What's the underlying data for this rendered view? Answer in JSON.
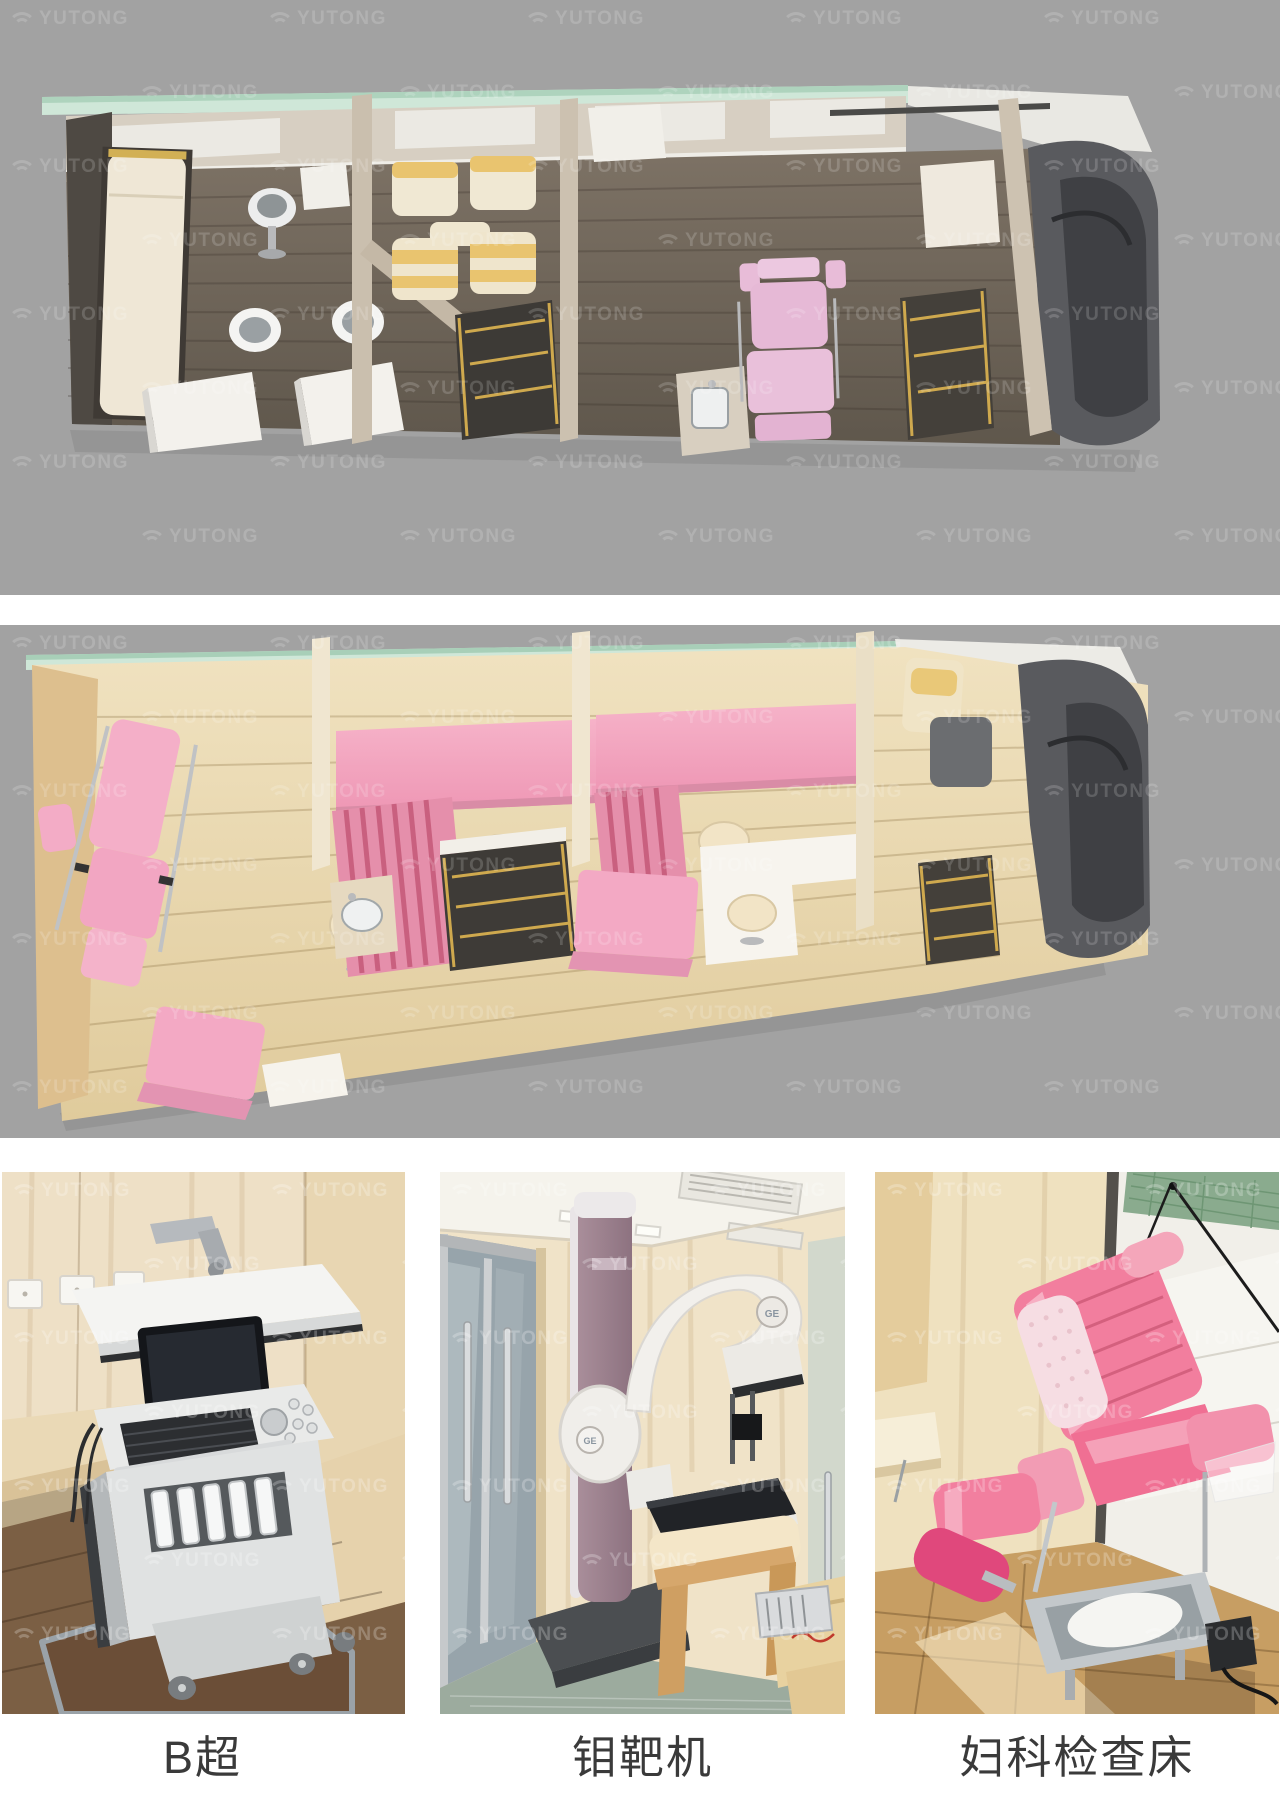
{
  "watermark": {
    "text": "YUTONG"
  },
  "photos": [
    {
      "caption": "B超"
    },
    {
      "caption": "钼靶机",
      "machine_logo": "GE"
    },
    {
      "caption": "妇科检查床"
    }
  ],
  "colors": {
    "panel_gray": "#a2a2a2",
    "glass_green": "#cfe7d8",
    "dark_wood_floor": "#6e6459",
    "light_wood_floor": "#ecdcb8",
    "accent_pink": "#f3aac4",
    "seat_yellow": "#e9c46f",
    "step_trim_gold": "#cfa94e",
    "cab_gray": "#595a5e",
    "caption_text": "#3a3a3a"
  }
}
